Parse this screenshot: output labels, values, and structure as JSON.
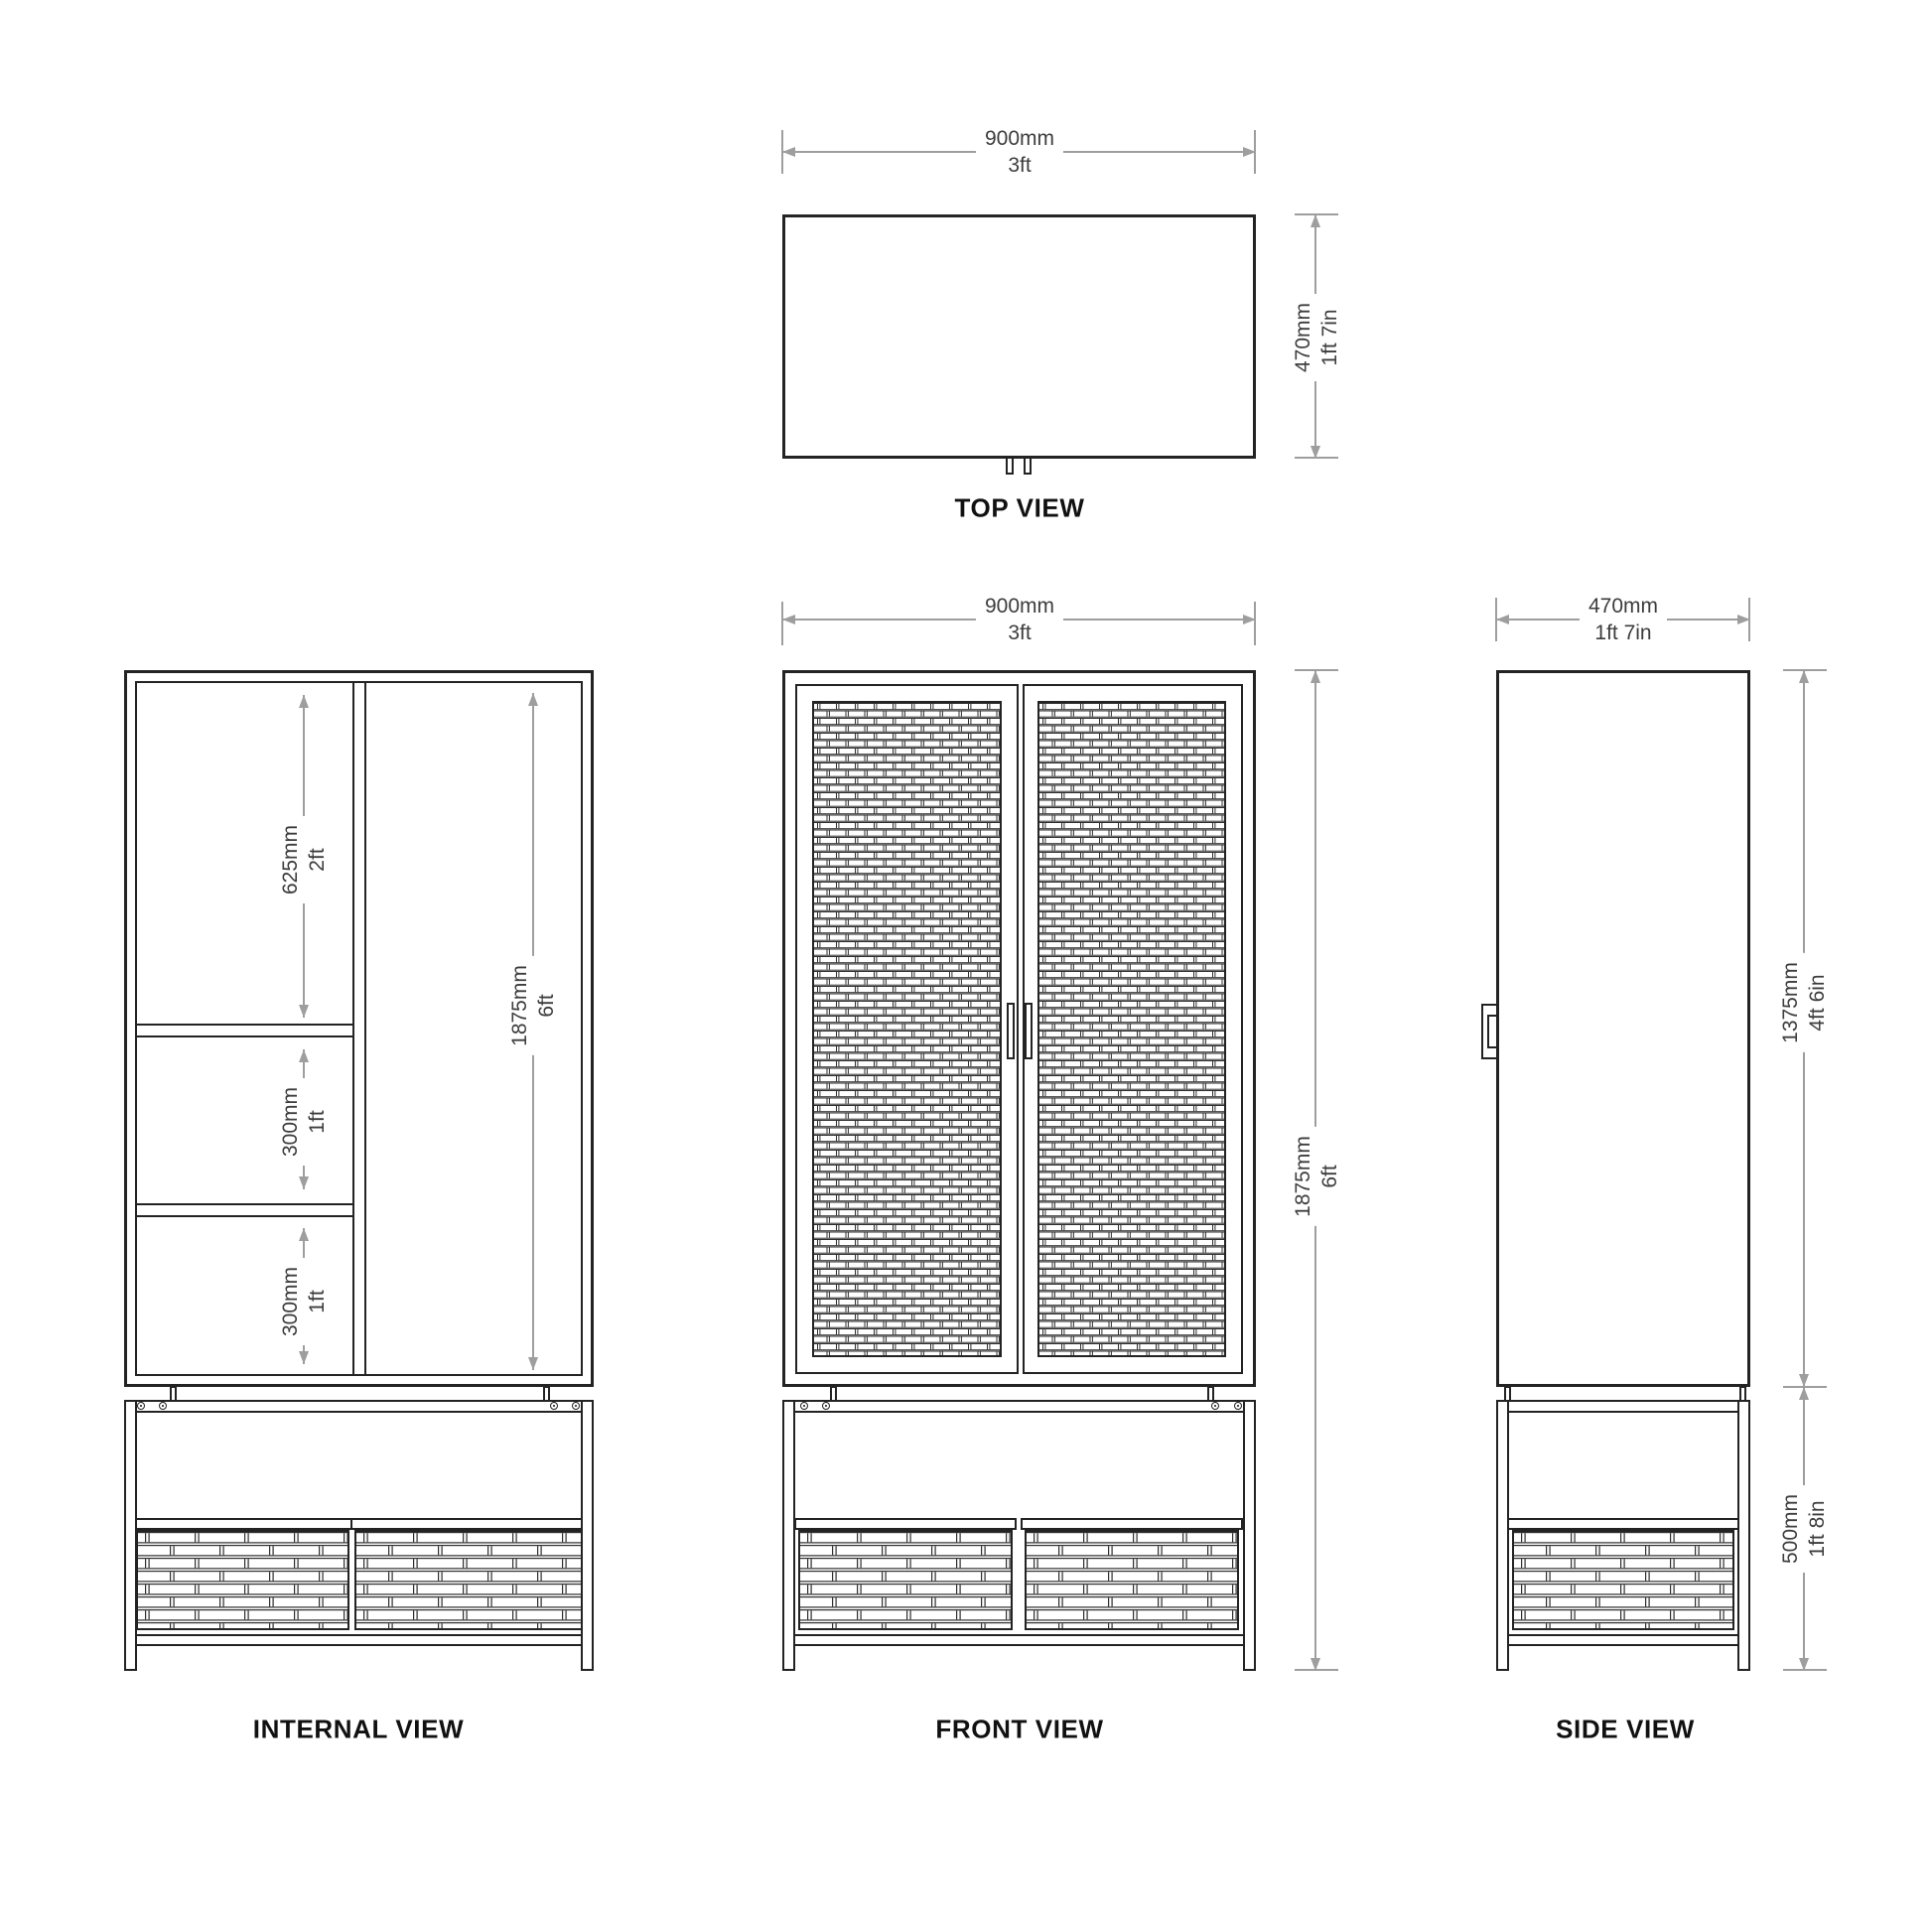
{
  "views": {
    "top": {
      "caption": "TOP VIEW",
      "width": {
        "metric": "900mm",
        "imperial": "3ft"
      },
      "depth": {
        "metric": "470mm",
        "imperial": "1ft 7in"
      }
    },
    "front": {
      "caption": "FRONT VIEW",
      "width": {
        "metric": "900mm",
        "imperial": "3ft"
      },
      "height": {
        "metric": "1875mm",
        "imperial": "6ft"
      }
    },
    "side": {
      "caption": "SIDE VIEW",
      "width": {
        "metric": "470mm",
        "imperial": "1ft 7in"
      },
      "body_height": {
        "metric": "1375mm",
        "imperial": "4ft 6in"
      },
      "base_height": {
        "metric": "500mm",
        "imperial": "1ft 8in"
      }
    },
    "internal": {
      "caption": "INTERNAL VIEW",
      "top_compartment": {
        "metric": "625mm",
        "imperial": "2ft"
      },
      "middle_compartment": {
        "metric": "300mm",
        "imperial": "1ft"
      },
      "bottom_compartment": {
        "metric": "300mm",
        "imperial": "1ft"
      },
      "full_height": {
        "metric": "1875mm",
        "imperial": "6ft"
      }
    }
  },
  "colors": {
    "line": "#232323",
    "dimension": "#9e9e9e",
    "dim_text": "#3d3d3d",
    "caption": "#111111",
    "background": "#ffffff"
  }
}
